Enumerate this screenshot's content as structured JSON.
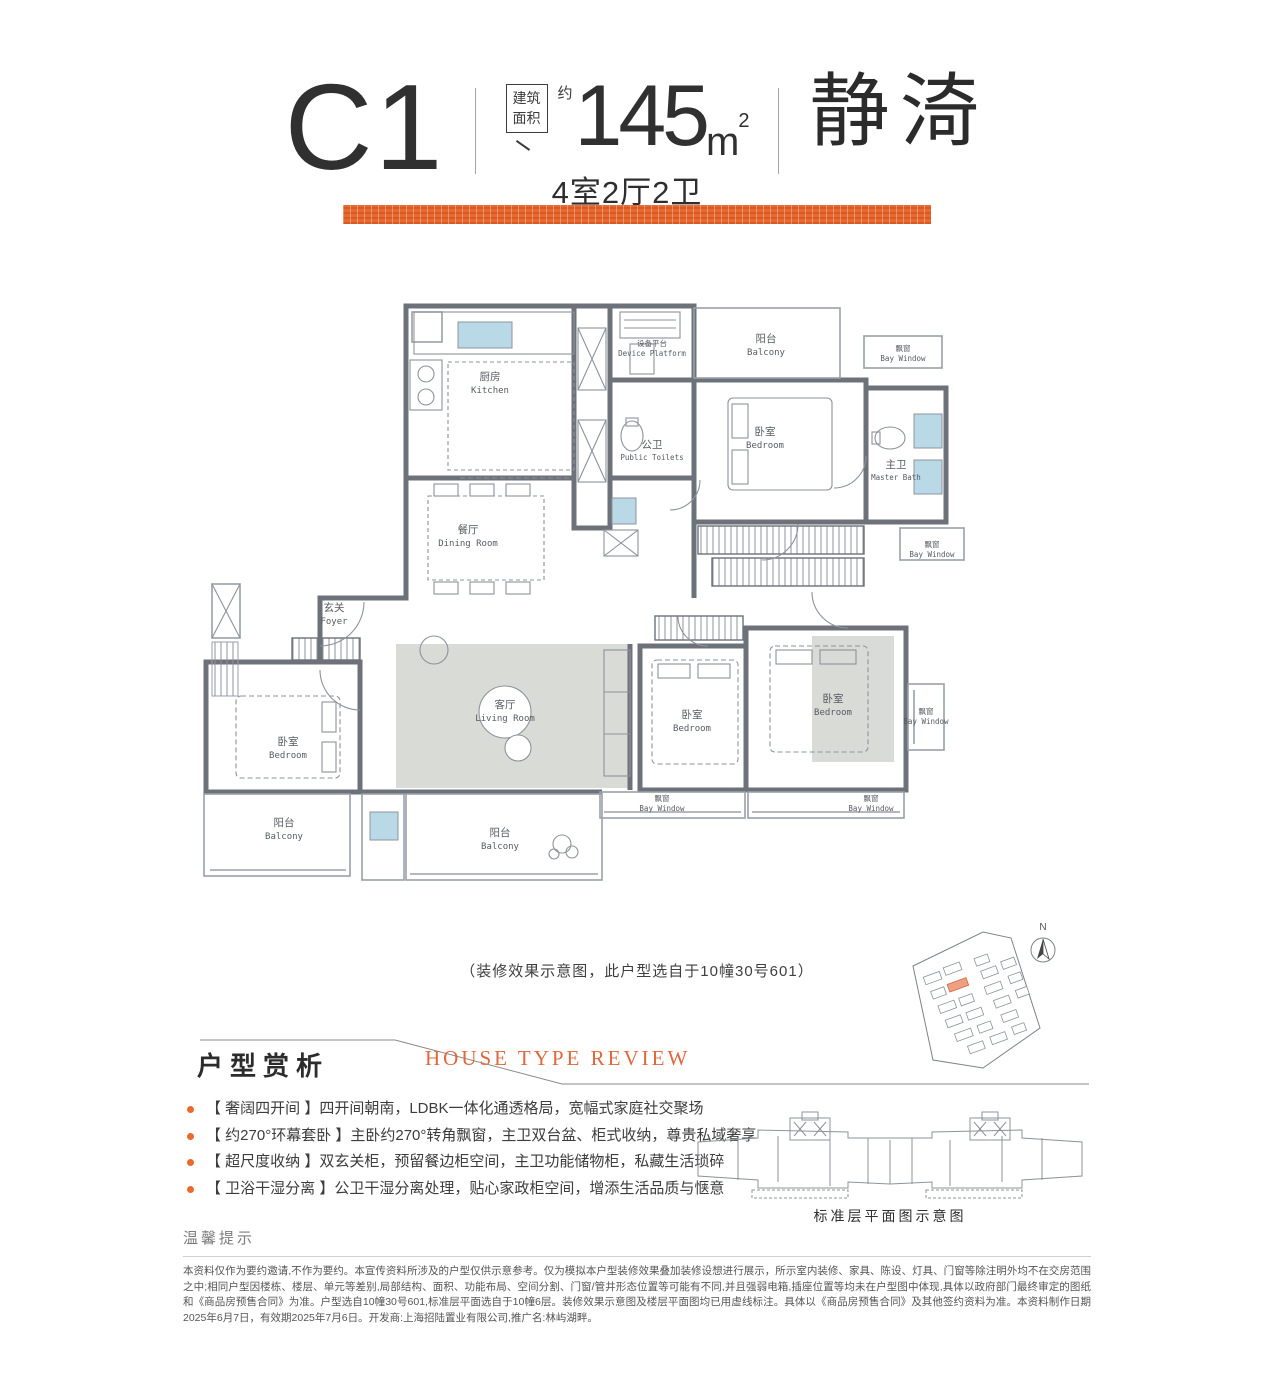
{
  "header": {
    "unit_code": "C1",
    "area_label_line1": "建筑",
    "area_label_line2": "面积",
    "area_approx": "约",
    "area_value": "145",
    "area_unit": "m",
    "area_sup": "2",
    "layout_text": "4室2厅2卫",
    "unit_name": "静渏"
  },
  "colors": {
    "accent_orange": "#E9692F",
    "wall_gray": "#6D727A",
    "fixture_blue": "#B9D9E7"
  },
  "floor_plan": {
    "caption": "（装修效果示意图，此户型选自于10幢30号601）",
    "north_label": "N",
    "rooms": {
      "kitchen": {
        "cn": "厨房",
        "en": "Kitchen"
      },
      "device_platform": {
        "cn": "设备平台",
        "en": "Device Platform"
      },
      "public_toilet": {
        "cn": "公卫",
        "en": "Public Toilets"
      },
      "balcony_top": {
        "cn": "阳台",
        "en": "Balcony"
      },
      "bay_window_top": {
        "cn": "飘窗",
        "en": "Bay Window"
      },
      "bedroom_suite": {
        "cn": "卧室",
        "en": "Bedroom"
      },
      "master_bath": {
        "cn": "主卫",
        "en": "Master Bath"
      },
      "bay_window_right_upper": {
        "cn": "飘窗",
        "en": "Bay Window"
      },
      "dining_room": {
        "cn": "餐厅",
        "en": "Dining Room"
      },
      "foyer": {
        "cn": "玄关",
        "en": "Foyer"
      },
      "living_room": {
        "cn": "客厅",
        "en": "Living Room"
      },
      "bedroom_left": {
        "cn": "卧室",
        "en": "Bedroom"
      },
      "balcony_left": {
        "cn": "阳台",
        "en": "Balcony"
      },
      "balcony_middle": {
        "cn": "阳台",
        "en": "Balcony"
      },
      "bedroom_middle": {
        "cn": "卧室",
        "en": "Bedroom"
      },
      "bedroom_right": {
        "cn": "卧室",
        "en": "Bedroom"
      },
      "bay_window_bottom_left": {
        "cn": "飘窗",
        "en": "Bay Window"
      },
      "bay_window_bottom_right": {
        "cn": "飘窗",
        "en": "Bay Window"
      },
      "bay_window_right_lower": {
        "cn": "飘窗",
        "en": "Bay Window"
      }
    }
  },
  "review": {
    "title_cn": "户型赏析",
    "title_en": "HOUSE TYPE REVIEW",
    "bullets": [
      "【 奢阔四开间 】四开间朝南，LDBK一体化通透格局，宽幅式家庭社交聚场",
      "【 约270°环幕套卧 】主卧约270°转角飘窗，主卫双台盆、柜式收纳，尊贵私域奢享",
      "【 超尺度收纳 】双玄关柜，预留餐边柜空间，主卫功能储物柜，私藏生活琐碎",
      "【 卫浴干湿分离 】公卫干湿分离处理，贴心家政柜空间，增添生活品质与惬意"
    ]
  },
  "standard_floor": {
    "caption": "标准层平面图示意图"
  },
  "notice": {
    "title": "温馨提示",
    "disclaimer": "本资料仅作为要约邀请,不作为要约。本宣传资料所涉及的户型仅供示意参考。仅为模拟本户型装修效果叠加装修设想进行展示，所示室内装修、家具、陈设、灯具、门窗等除注明外均不在交房范围之中;相同户型因楼栋、楼层、单元等差别,局部结构、面积、功能布局、空间分割、门窗/管井形态位置等可能有不同,并且强弱电箱,插座位置等均未在户型图中体现,具体以政府部门最终审定的图纸和《商品房预售合同》为准。户型选自10幢30号601,标准层平面选自于10幢6层。装修效果示意图及楼层平面图均已用虚线标注。具体以《商品房预售合同》及其他签约资料为准。本资料制作日期2025年6月7日，有效期2025年7月6日。开发商:上海招陆置业有限公司,推广名:林屿湖畔。"
  }
}
